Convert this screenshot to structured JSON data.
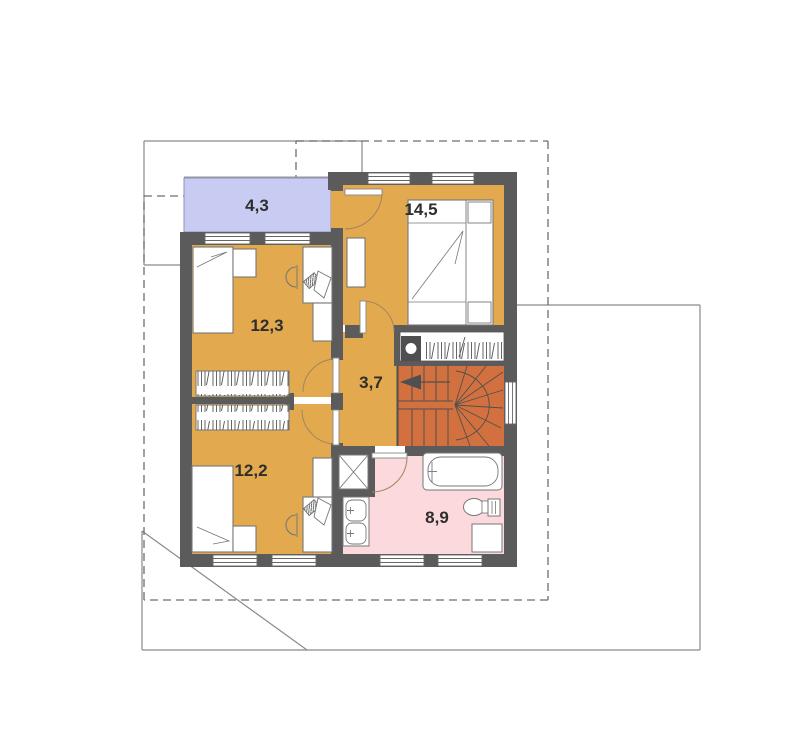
{
  "plan": {
    "title": "floor-plan",
    "rooms": [
      {
        "name": "balcony",
        "area": "4,3"
      },
      {
        "name": "bedroom-large",
        "area": "14,5"
      },
      {
        "name": "bedroom-upper-left",
        "area": "12,3"
      },
      {
        "name": "hallway",
        "area": "3,7"
      },
      {
        "name": "bedroom-lower-left",
        "area": "12,2"
      },
      {
        "name": "bathroom",
        "area": "8,9"
      }
    ],
    "colors": {
      "wall": "#5b5b5b",
      "floor": "#e3a94f",
      "stairs": "#d2713f",
      "balcony": "#c9ccf2",
      "bathroom": "#fbd9dc",
      "door_arc": "#a08460",
      "site_line": "#8a8a8a",
      "roof_dash": "#6e6e6e",
      "label": "#2e2e2e"
    }
  }
}
